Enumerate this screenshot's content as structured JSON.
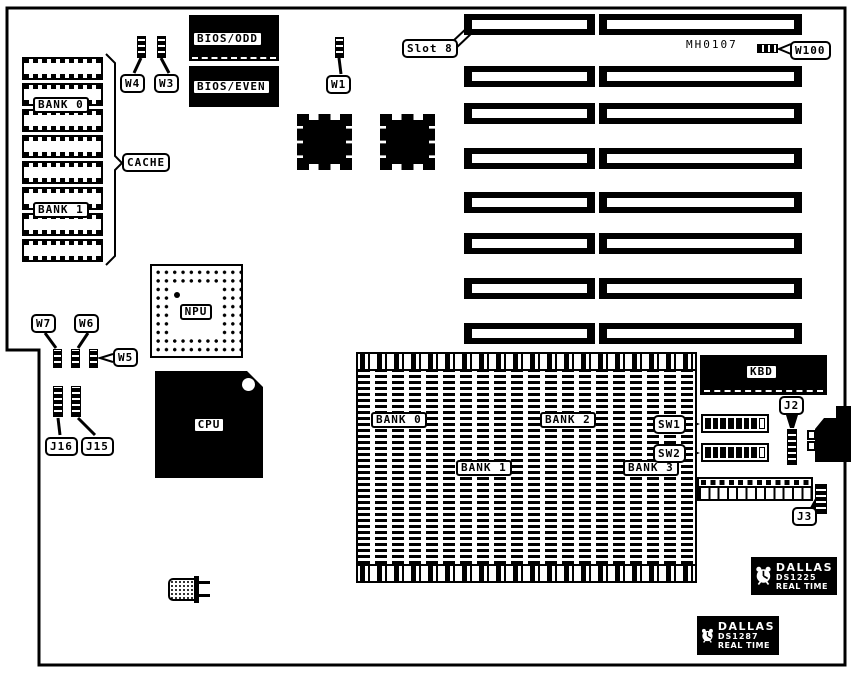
{
  "colors": {
    "ink": "#000000",
    "paper": "#ffffff"
  },
  "board": {
    "part_number": "MH0107"
  },
  "callouts": {
    "slot8": "Slot 8",
    "w100": "W100",
    "w1": "W1",
    "w3": "W3",
    "w4": "W4",
    "w5": "W5",
    "w6": "W6",
    "w7": "W7",
    "j2": "J2",
    "j3": "J3",
    "j15": "J15",
    "j16": "J16",
    "sw1": "SW1",
    "sw2": "SW2",
    "cache": "CACHE"
  },
  "chips": {
    "bios_odd": "BIOS/ODD",
    "bios_even": "BIOS/EVEN",
    "npu": "NPU",
    "cpu": "CPU",
    "kbd": "KBD"
  },
  "cache_banks": [
    "BANK 0",
    "BANK 1"
  ],
  "memory_banks": [
    "BANK 0",
    "BANK 1",
    "BANK 2",
    "BANK 3"
  ],
  "rtc": {
    "ds1225": {
      "brand": "DALLAS",
      "model": "DS1225",
      "line": "REAL TIME"
    },
    "ds1287": {
      "brand": "DALLAS",
      "model": "DS1287",
      "line": "REAL TIME"
    }
  }
}
